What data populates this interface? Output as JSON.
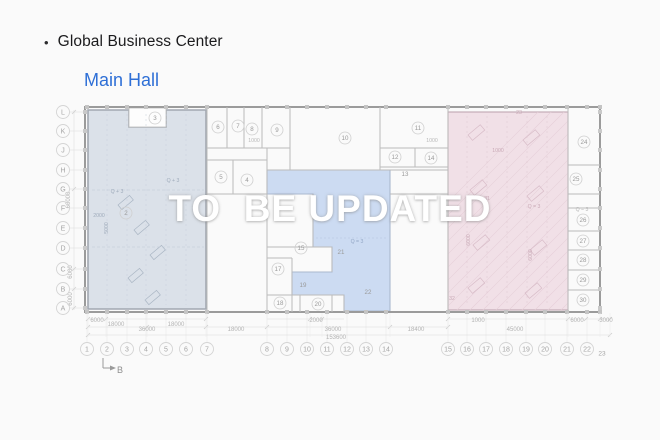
{
  "header": {
    "bullet": "•",
    "building_name": "Global Business Center",
    "hall_title": "Main Hall"
  },
  "watermark_text": "TO  BE UPDATED",
  "colors": {
    "title_blue": "#2e6fd6",
    "zone_left_fill": "#d8dee7",
    "zone_left_stroke": "#a2a8b1",
    "zone_middle_fill": "#c9d9f1",
    "zone_middle_stroke": "#aab8cf",
    "zone_right_fill": "#efdde4",
    "zone_right_stroke": "#c0a7b2",
    "outer_wall": "#9b9b9b",
    "inner_wall": "#bbbbbb",
    "grid_label": "#a5a5a5",
    "dim_text": "#b3b3b3",
    "room_text": "#9a9a9a",
    "pink_detail": "#c9a9b6",
    "left_detail": "#aab6c4"
  },
  "plan": {
    "row_labels": [
      {
        "label": "L",
        "y": 112
      },
      {
        "label": "K",
        "y": 131
      },
      {
        "label": "J",
        "y": 150
      },
      {
        "label": "H",
        "y": 170
      },
      {
        "label": "G",
        "y": 189
      },
      {
        "label": "F",
        "y": 208
      },
      {
        "label": "E",
        "y": 228
      },
      {
        "label": "D",
        "y": 248
      },
      {
        "label": "C",
        "y": 269
      },
      {
        "label": "B",
        "y": 289
      },
      {
        "label": "A",
        "y": 308
      }
    ],
    "col_labels": [
      {
        "label": "1",
        "x": 87
      },
      {
        "label": "2",
        "x": 107
      },
      {
        "label": "3",
        "x": 127
      },
      {
        "label": "4",
        "x": 146
      },
      {
        "label": "5",
        "x": 166
      },
      {
        "label": "6",
        "x": 186
      },
      {
        "label": "7",
        "x": 207
      },
      {
        "label": "8",
        "x": 267
      },
      {
        "label": "9",
        "x": 287
      },
      {
        "label": "10",
        "x": 307
      },
      {
        "label": "11",
        "x": 327
      },
      {
        "label": "12",
        "x": 347
      },
      {
        "label": "13",
        "x": 366
      },
      {
        "label": "14",
        "x": 386
      },
      {
        "label": "15",
        "x": 448
      },
      {
        "label": "16",
        "x": 467
      },
      {
        "label": "17",
        "x": 486
      },
      {
        "label": "18",
        "x": 506
      },
      {
        "label": "19",
        "x": 526
      },
      {
        "label": "20",
        "x": 545
      },
      {
        "label": "21",
        "x": 567
      },
      {
        "label": "22",
        "x": 587
      },
      {
        "label": "23",
        "x": 602,
        "small": true
      }
    ],
    "rooms": [
      {
        "label": "3",
        "x": 155,
        "y": 118,
        "circle": true
      },
      {
        "label": "6",
        "x": 218,
        "y": 127,
        "circle": true
      },
      {
        "label": "7",
        "x": 238,
        "y": 126,
        "circle": true
      },
      {
        "label": "8",
        "x": 252,
        "y": 129,
        "circle": true
      },
      {
        "label": "9",
        "x": 277,
        "y": 130,
        "circle": true
      },
      {
        "label": "10",
        "x": 345,
        "y": 138,
        "circle": true
      },
      {
        "label": "11",
        "x": 418,
        "y": 128,
        "circle": true
      },
      {
        "label": "12",
        "x": 395,
        "y": 157,
        "circle": true
      },
      {
        "label": "14",
        "x": 431,
        "y": 158,
        "circle": true
      },
      {
        "label": "13",
        "x": 405,
        "y": 174,
        "circle": false
      },
      {
        "label": "5",
        "x": 221,
        "y": 177,
        "circle": true
      },
      {
        "label": "4",
        "x": 247,
        "y": 180,
        "circle": true
      },
      {
        "label": "2",
        "x": 126,
        "y": 213,
        "circle": true
      },
      {
        "label": "15",
        "x": 301,
        "y": 248,
        "circle": true
      },
      {
        "label": "17",
        "x": 278,
        "y": 269,
        "circle": true
      },
      {
        "label": "19",
        "x": 303,
        "y": 285,
        "circle": false
      },
      {
        "label": "18",
        "x": 280,
        "y": 303,
        "circle": true
      },
      {
        "label": "20",
        "x": 318,
        "y": 304,
        "circle": true
      },
      {
        "label": "21",
        "x": 341,
        "y": 252,
        "circle": false
      },
      {
        "label": "22",
        "x": 368,
        "y": 292,
        "circle": false
      },
      {
        "label": "24",
        "x": 584,
        "y": 142,
        "circle": true
      },
      {
        "label": "25",
        "x": 576,
        "y": 179,
        "circle": true
      },
      {
        "label": "26",
        "x": 583,
        "y": 220,
        "circle": true
      },
      {
        "label": "27",
        "x": 583,
        "y": 241,
        "circle": true
      },
      {
        "label": "28",
        "x": 583,
        "y": 260,
        "circle": true
      },
      {
        "label": "29",
        "x": 583,
        "y": 280,
        "circle": true
      },
      {
        "label": "30",
        "x": 583,
        "y": 300,
        "circle": true
      }
    ],
    "annotations": [
      {
        "text": "Q + 3",
        "x": 117,
        "y": 193,
        "tone": "left"
      },
      {
        "text": "Q + 3",
        "x": 173,
        "y": 182,
        "tone": "left"
      },
      {
        "text": "2000",
        "x": 99,
        "y": 217,
        "tone": "left"
      },
      {
        "text": "5000",
        "x": 108,
        "y": 228,
        "tone": "left",
        "vertical": true
      },
      {
        "text": "1000",
        "x": 254,
        "y": 142,
        "tone": "gray"
      },
      {
        "text": "1000",
        "x": 432,
        "y": 142,
        "tone": "gray"
      },
      {
        "text": "Q = 3",
        "x": 357,
        "y": 243,
        "tone": "mid"
      },
      {
        "text": "23",
        "x": 519,
        "y": 114,
        "tone": "pink"
      },
      {
        "text": "1000",
        "x": 498,
        "y": 152,
        "tone": "pink"
      },
      {
        "text": "31",
        "x": 487,
        "y": 200,
        "tone": "pink"
      },
      {
        "text": "32",
        "x": 452,
        "y": 300,
        "tone": "pink"
      },
      {
        "text": "Q = 3",
        "x": 534,
        "y": 208,
        "tone": "pink"
      },
      {
        "text": "Q = 3",
        "x": 582,
        "y": 211,
        "tone": "gray"
      },
      {
        "text": "6000",
        "x": 470,
        "y": 240,
        "tone": "pink",
        "vertical": true
      },
      {
        "text": "6000",
        "x": 532,
        "y": 255,
        "tone": "pink",
        "vertical": true
      }
    ],
    "dims_h": [
      {
        "text": "6000",
        "x": 97,
        "y": 322
      },
      {
        "text": "18000",
        "x": 116,
        "y": 326
      },
      {
        "text": "18000",
        "x": 176,
        "y": 326
      },
      {
        "text": "36000",
        "x": 147,
        "y": 331
      },
      {
        "text": "18000",
        "x": 236,
        "y": 331
      },
      {
        "text": "2000",
        "x": 316,
        "y": 322
      },
      {
        "text": "36000",
        "x": 333,
        "y": 331
      },
      {
        "text": "18400",
        "x": 416,
        "y": 331
      },
      {
        "text": "1000",
        "x": 478,
        "y": 322
      },
      {
        "text": "45000",
        "x": 515,
        "y": 331
      },
      {
        "text": "6000",
        "x": 577,
        "y": 322
      },
      {
        "text": "3000",
        "x": 606,
        "y": 322
      },
      {
        "text": "153600",
        "x": 336,
        "y": 339
      }
    ],
    "dims_v": [
      {
        "text": "60000",
        "x": 70,
        "y": 200
      },
      {
        "text": "6000",
        "x": 72,
        "y": 272
      },
      {
        "text": "6000",
        "x": 72,
        "y": 299
      }
    ],
    "section_marker": {
      "label": "B",
      "x": 120,
      "y": 373
    }
  }
}
